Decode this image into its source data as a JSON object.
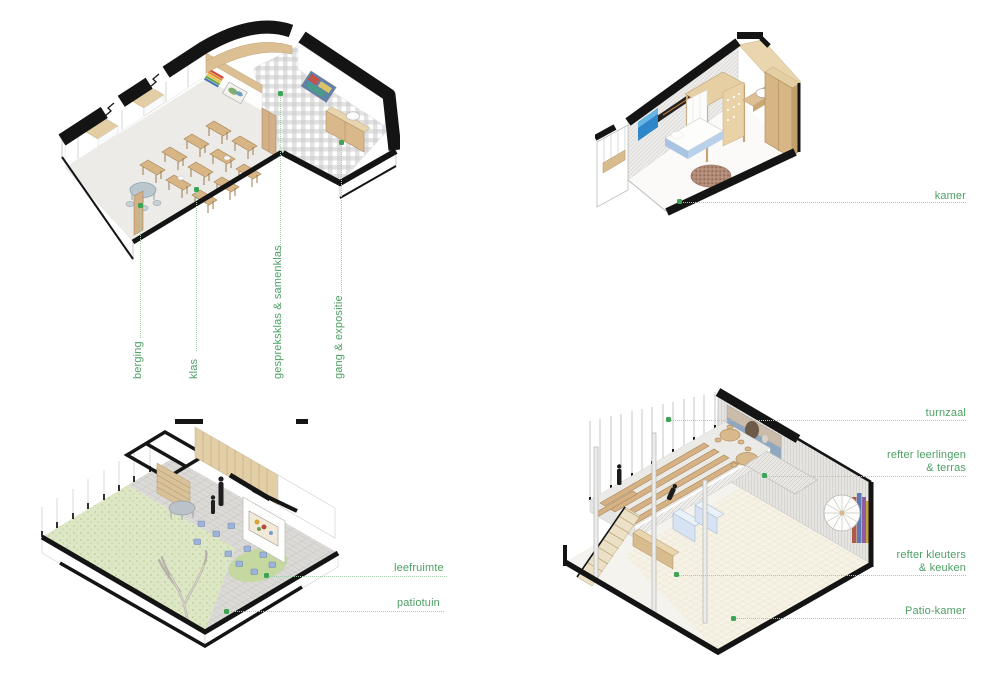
{
  "annotations": {
    "classroom": {
      "berging": "berging",
      "klas": "klas",
      "gespreksklas_samenklas": "gespreksklas & samenklas",
      "gang_expositie": "gang & expositie"
    },
    "bedroom": {
      "kamer": "kamer"
    },
    "living": {
      "leefruimte": "leefruimte",
      "patiotuin": "patiotuin"
    },
    "refectory": {
      "turnzaal": "turnzaal",
      "refter_leerlingen_line1": "refter leerlingen",
      "refter_leerlingen_line2": "& terras",
      "refter_kleuters_line1": "refter kleuters",
      "refter_kleuters_line2": "& keuken",
      "patio_kamer": "Patio-kamer"
    }
  },
  "colors": {
    "label_text": "#4d9f63",
    "anchor_dot": "#3da455",
    "leader_line": "#9ecfaa",
    "cut_wall_black": "#141414",
    "wood_light": "#d9b88c",
    "gingham_gray": "#c9c9c9",
    "grass_green": "#dde7c6",
    "stool_blue": "#9db3d9",
    "floor_light": "#ecebe7"
  }
}
